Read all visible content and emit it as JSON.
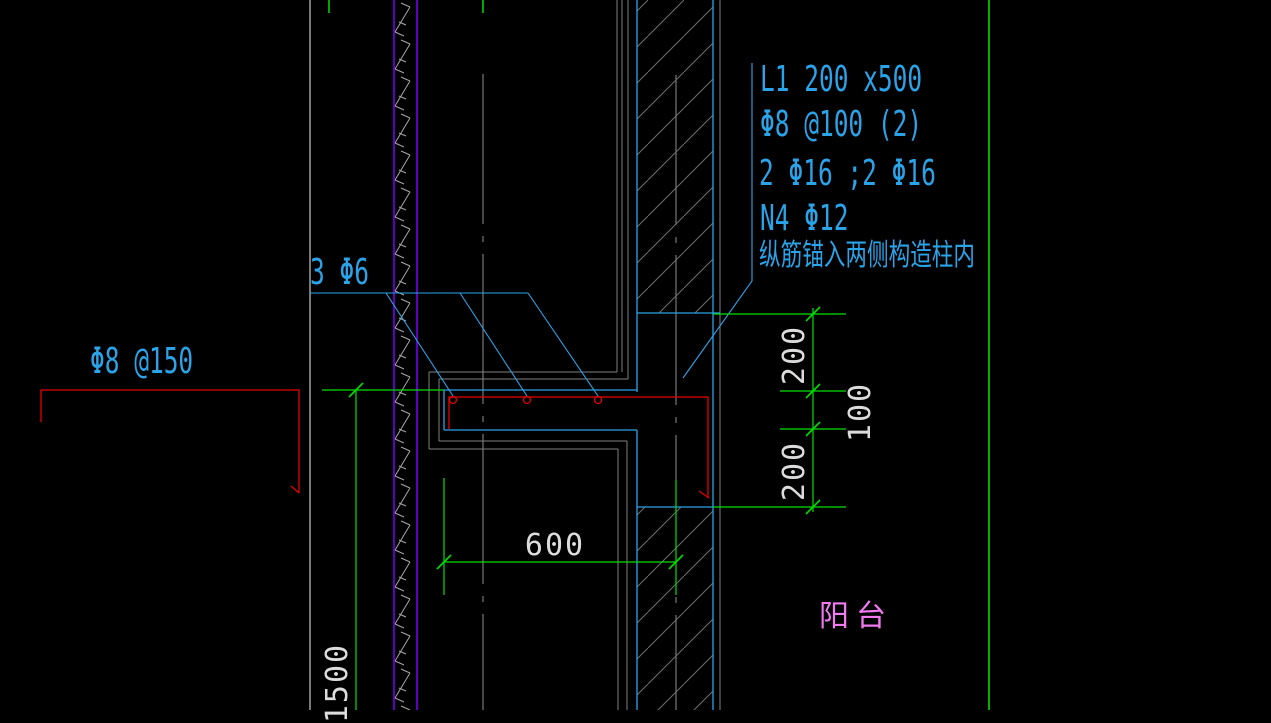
{
  "colors": {
    "background": "#000000",
    "cyan": "#2BA3E8",
    "green": "#00DF00",
    "red": "#E60000",
    "purple": "#7F00FF",
    "gray": "#808080",
    "light-gray": "#C8C8C8",
    "hatch-gray": "#6E6E6E",
    "dim-text": "#DCDCDC",
    "magenta": "#F07AF0"
  },
  "annotations": {
    "beam_spec": {
      "line1": "L1 200 x500",
      "line2": "Φ8 @100 (2)",
      "line3": "2 Φ16 ;2 Φ16",
      "line4": "N4 Φ12",
      "line5": "纵筋锚入两侧构造柱内"
    },
    "top_bars_label": "3 Φ6",
    "wall_mesh_label": "Φ8 @150",
    "room_label": "阳台"
  },
  "dimensions": {
    "right_top": "200",
    "right_middle": "100",
    "right_bottom": "200",
    "bottom_width": "600",
    "left_height": "1500"
  }
}
